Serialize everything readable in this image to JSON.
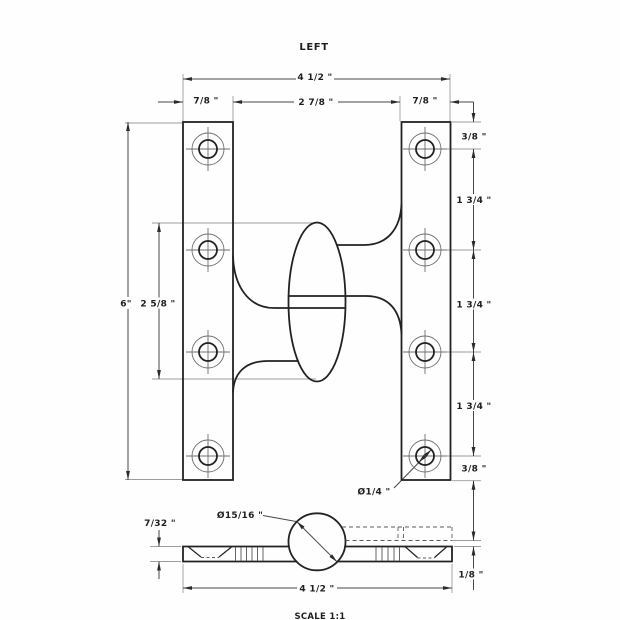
{
  "title": "LEFT",
  "scale_note": "SCALE 1:1",
  "drawing": {
    "type": "hinge-technical-drawing",
    "hand": "LEFT",
    "views": [
      "front",
      "bottom"
    ]
  },
  "front_view": {
    "dim_overall_width": "4 1/2 \"",
    "dim_left_leaf_width": "7/8 \"",
    "dim_center_width": "2 7/8 \"",
    "dim_right_leaf_width": "7/8 \"",
    "dim_overall_height": "6\"",
    "dim_knuckle_height": "2 5/8 \"",
    "dim_chain": [
      "3/8 \"",
      "1 3/4 \"",
      "1 3/4 \"",
      "1 3/4 \"",
      "3/8 \""
    ],
    "dim_hole_diameter": "Ø1/4 \"",
    "hole_count": 8
  },
  "bottom_view": {
    "dim_knuckle_diameter": "Ø15/16 \"",
    "dim_leaf_thickness": "7/32 \"",
    "dim_overall_width": "4 1/2 \"",
    "dim_leaf_offset": "1/8 \""
  },
  "colors": {
    "background": "#fdfefd",
    "outline": "#222222",
    "dimension_line": "#474747",
    "extension_line": "#9c9c9c",
    "hole_secondary": "#6e6e6e",
    "text": "#1f1f1f"
  }
}
